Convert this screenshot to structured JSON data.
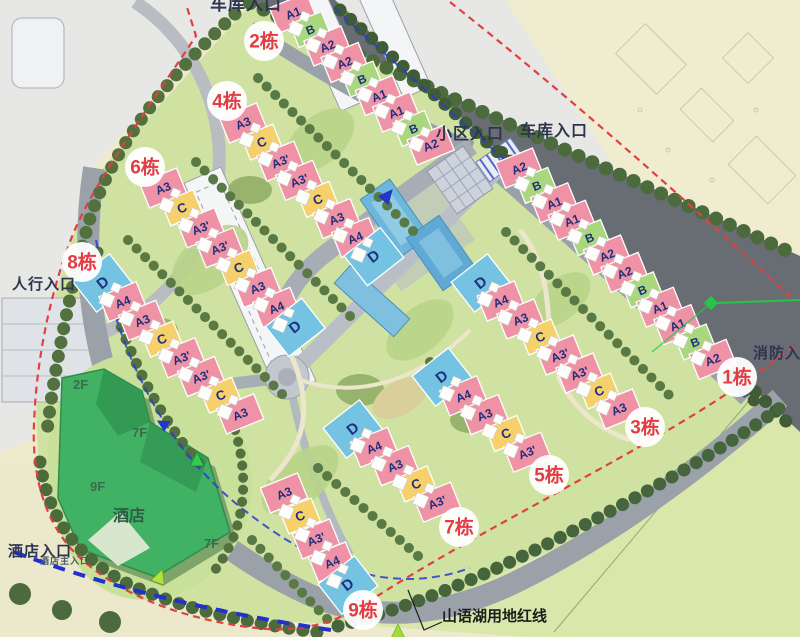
{
  "map_title": "residential master plan",
  "colors": {
    "boundary_red": "#e04040",
    "route_blue": "#2b3bd0",
    "badge_text_red": "#e23c44",
    "unit_text_navy": "#20307c",
    "road_gray": "#9aa1a8",
    "main_road_dark": "#686d73",
    "lawn_green": "#cfe2a2",
    "hotel_green": "#41b264",
    "water_blue": "#64aed8"
  },
  "unit_types": {
    "A1": {
      "fill": "#ef92a5",
      "size": [
        40,
        27
      ],
      "rot": -22,
      "fs": 12
    },
    "A2": {
      "fill": "#ef92a5",
      "size": [
        40,
        27
      ],
      "rot": -22,
      "fs": 12
    },
    "A3": {
      "fill": "#ef92a5",
      "size": [
        40,
        27
      ],
      "rot": -22,
      "fs": 12
    },
    "A3'": {
      "fill": "#ef92a5",
      "size": [
        40,
        27
      ],
      "rot": -22,
      "fs": 12
    },
    "A4": {
      "fill": "#ef92a5",
      "size": [
        40,
        27
      ],
      "rot": -22,
      "fs": 12
    },
    "B": {
      "fill": "#a8d77d",
      "size": [
        34,
        25
      ],
      "rot": -22,
      "fs": 12
    },
    "C": {
      "fill": "#f6d06b",
      "size": [
        34,
        25
      ],
      "rot": -22,
      "fs": 13
    },
    "D": {
      "fill": "#74c3e2",
      "size": [
        46,
        38
      ],
      "rot": -38,
      "fs": 15
    }
  },
  "rows": [
    {
      "name": "2栋",
      "badge": {
        "x": 264,
        "y": 41
      },
      "start": [
        293,
        13
      ],
      "step": [
        17.2,
        16.5
      ],
      "units": [
        "A1",
        "B",
        "A2",
        "A2",
        "B",
        "A1",
        "A1",
        "B",
        "A2"
      ]
    },
    {
      "name": "1栋",
      "badge": {
        "x": 737,
        "y": 377
      },
      "start": [
        519,
        168
      ],
      "step": [
        17.6,
        17.4
      ],
      "units": [
        "A2",
        "B",
        "A1",
        "A1",
        "B",
        "A2",
        "A2",
        "B",
        "A1",
        "A1",
        "B",
        "A2"
      ]
    },
    {
      "name": "4栋",
      "badge": {
        "x": 227,
        "y": 101
      },
      "start": [
        243,
        123
      ],
      "step": [
        18.7,
        19.1
      ],
      "units": [
        "A3",
        "C",
        "A3'",
        "A3'",
        "C",
        "A3",
        "A4",
        "D"
      ]
    },
    {
      "name": "6栋",
      "badge": {
        "x": 145,
        "y": 167
      },
      "start": [
        163,
        188
      ],
      "step": [
        18.9,
        19.9
      ],
      "units": [
        "A3",
        "C",
        "A3'",
        "A3'",
        "C",
        "A3",
        "A4",
        "D"
      ]
    },
    {
      "name": "8栋",
      "badge": {
        "x": 82,
        "y": 262
      },
      "start": [
        103,
        283
      ],
      "step": [
        19.6,
        18.7
      ],
      "units": [
        "D",
        "A4",
        "A3",
        "C",
        "A3'",
        "A3'",
        "C",
        "A3"
      ]
    },
    {
      "name": "3栋",
      "badge": {
        "x": 645,
        "y": 427
      },
      "start": [
        481,
        283
      ],
      "step": [
        19.7,
        18.0
      ],
      "units": [
        "D",
        "A4",
        "A3",
        "C",
        "A3'",
        "A3'",
        "C",
        "A3"
      ]
    },
    {
      "name": "5栋",
      "badge": {
        "x": 549,
        "y": 475
      },
      "start": [
        442,
        377
      ],
      "step": [
        21.3,
        18.8
      ],
      "units": [
        "D",
        "A4",
        "A3",
        "C",
        "A3'"
      ]
    },
    {
      "name": "7栋",
      "badge": {
        "x": 459,
        "y": 527
      },
      "start": [
        353,
        429
      ],
      "step": [
        21.0,
        18.3
      ],
      "units": [
        "D",
        "A4",
        "A3",
        "C",
        "A3'"
      ]
    },
    {
      "name": "9栋",
      "badge": {
        "x": 363,
        "y": 610
      },
      "start": [
        284,
        493
      ],
      "step": [
        16.0,
        23.0
      ],
      "units": [
        "A3",
        "C",
        "A3'",
        "A4",
        "D"
      ]
    }
  ],
  "entrances": [
    {
      "id": "garage-entrance-top",
      "label": "车库入口",
      "x": 210,
      "y": 10,
      "size": 17,
      "color": "#2e3550"
    },
    {
      "id": "community-entrance",
      "label": "小区入口",
      "x": 436,
      "y": 139,
      "size": 16,
      "color": "#2e3550"
    },
    {
      "id": "garage-entrance-right",
      "label": "车库入口",
      "x": 520,
      "y": 136,
      "size": 16,
      "color": "#2e3550"
    },
    {
      "id": "pedestrian-entrance",
      "label": "人行入口",
      "x": 12,
      "y": 289,
      "size": 15,
      "color": "#2e3550"
    },
    {
      "id": "fire-entrance",
      "label": "消防入口",
      "x": 753,
      "y": 358,
      "size": 15,
      "color": "#2e3550"
    },
    {
      "id": "hotel-entrance",
      "label": "酒店入口",
      "x": 8,
      "y": 556,
      "size": 15,
      "color": "#2e3550"
    },
    {
      "id": "hotel-main-entrance",
      "label": "酒店主入口",
      "x": 40,
      "y": 564,
      "size": 9,
      "color": "#4a5a6a"
    }
  ],
  "hotel": {
    "name_label": {
      "label": "酒店",
      "x": 113,
      "y": 521,
      "size": 16,
      "color": "#2f5c44"
    },
    "floors": [
      {
        "label": "2F",
        "x": 73,
        "y": 389
      },
      {
        "label": "7F",
        "x": 132,
        "y": 437
      },
      {
        "label": "9F",
        "x": 90,
        "y": 491
      },
      {
        "label": "7F",
        "x": 204,
        "y": 548
      }
    ],
    "floor_color": "#3c6b4c"
  },
  "boundary_note": {
    "label": "山语湖用地红线",
    "x": 442,
    "y": 621,
    "size": 15,
    "color": "#1d1d1d",
    "leader": "442,622 424,630 408,590"
  }
}
